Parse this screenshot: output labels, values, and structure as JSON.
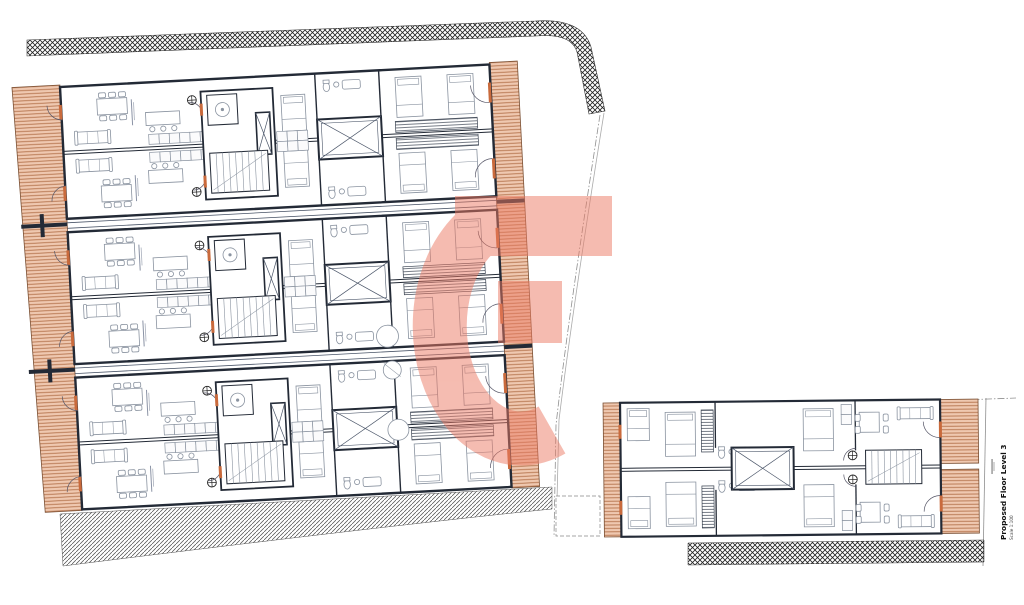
{
  "title_block": {
    "title": "Proposed Floor Level 3",
    "scale": "Scale 1:100"
  },
  "watermark": {
    "glyph": "G",
    "color": "#ec7a63",
    "opacity": 0.5
  },
  "colors": {
    "background": "#ffffff",
    "wall": "#232a36",
    "wall_light": "#4a5568",
    "furniture": "#8a93a0",
    "terrace_fill": "#efc8b0",
    "terrace_hatch": "#b5744e",
    "terrace_edge": "#7a5034",
    "party_wall_hatch": "#222222",
    "site_hatch": "#4a4a4a",
    "door_accent": "#c96a3c",
    "boundary": "#8f8f8f",
    "text": "#111111"
  },
  "drawing": {
    "large_building_strips": 3,
    "small_building_units": 2,
    "features": [
      "terraces",
      "staircases",
      "lift-shafts",
      "void-shafts",
      "bedrooms",
      "living-dining",
      "kitchens",
      "bathrooms"
    ]
  }
}
